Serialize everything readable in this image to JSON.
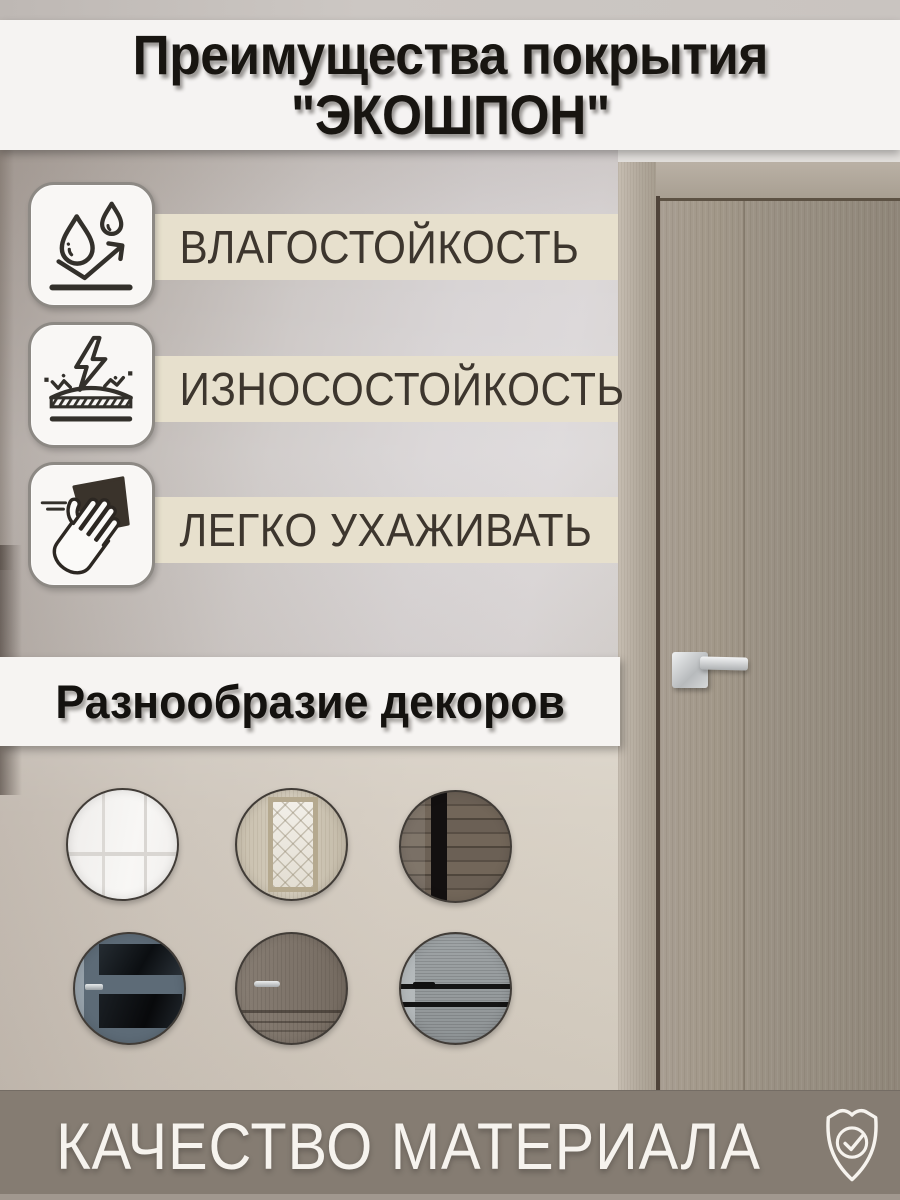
{
  "title": {
    "line1": "Преимущества покрытия",
    "line2": "\"ЭКОШПОН\""
  },
  "features": {
    "items": [
      {
        "label": "ВЛАГОСТОЙКОСТЬ",
        "icon": "water-drops-arrow-icon"
      },
      {
        "label": "ИЗНОСОСТОЙКОСТЬ",
        "icon": "lightning-impact-surface-icon"
      },
      {
        "label": "ЛЕГКО УХАЖИВАТЬ",
        "icon": "hand-wiping-cloth-icon"
      }
    ]
  },
  "decors": {
    "banner_label": "Разнообразие декоров",
    "items": [
      {
        "name": "white-classic-panel-door"
      },
      {
        "name": "light-wood-ornate-glass-door"
      },
      {
        "name": "dark-rustic-wood-door"
      },
      {
        "name": "blue-gray-door-with-dark-glass"
      },
      {
        "name": "gray-wood-panel-door"
      },
      {
        "name": "ash-gray-door-with-black-stripes"
      }
    ]
  },
  "footer": {
    "label": "КАЧЕСТВО МАТЕРИАЛА",
    "icon": "shield-check-icon"
  },
  "colors": {
    "feature_strip": "#e7e0cd",
    "feature_text": "#3d362e",
    "banner_bg": "#f6f4f2",
    "title_text": "#181511",
    "footer_band": "#857c72",
    "footer_text": "#f6f3ee"
  }
}
